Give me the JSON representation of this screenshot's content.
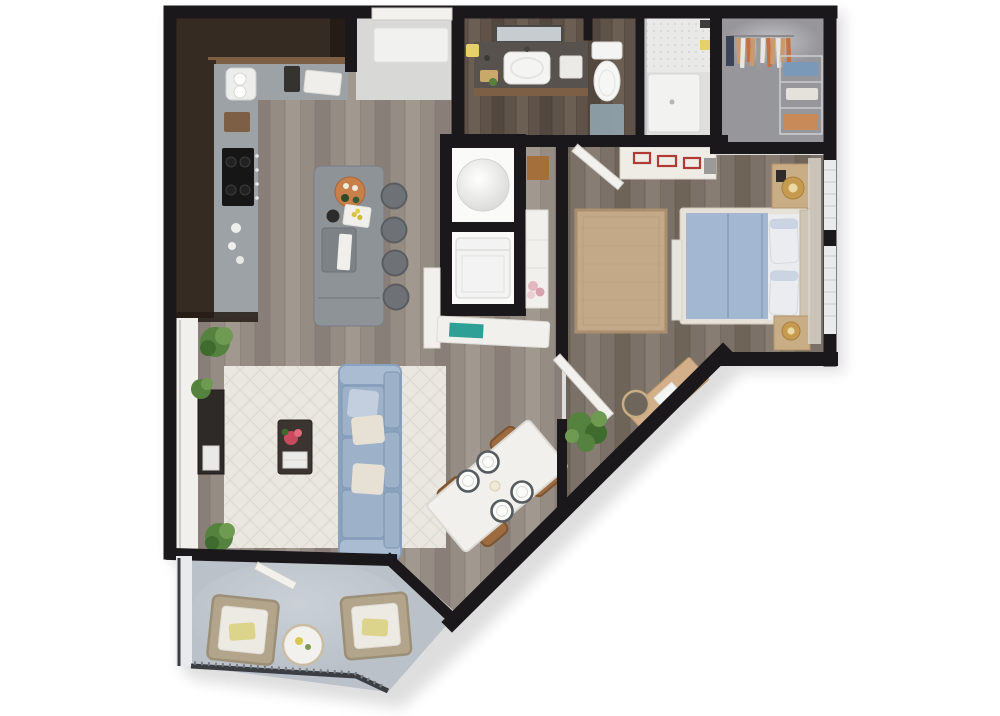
{
  "image_type": "3d-rendered-floor-plan",
  "description": "Top-down 3D dollhouse rendering of a one-bedroom apartment with balcony; no text labels are rendered in the image",
  "rooms": [
    {
      "id": "kitchen",
      "name": "kitchen",
      "contents": [
        "dark-l-shaped-cabinets",
        "double-sink",
        "cooktop",
        "refrigerator-column",
        "island-with-prep-sink",
        "four-bar-stools"
      ]
    },
    {
      "id": "entry",
      "name": "entry",
      "contents": [
        "entry-door",
        "white-door-mat"
      ]
    },
    {
      "id": "bathroom",
      "name": "bathroom",
      "contents": [
        "mirror",
        "vanity-with-basin",
        "toilet",
        "bath-mat",
        "walk-in-shower"
      ]
    },
    {
      "id": "closet",
      "name": "walk-in-closet",
      "contents": [
        "hanging-clothes-rod",
        "wire-shelving-with-folded-clothes"
      ]
    },
    {
      "id": "laundry",
      "name": "laundry-utility-closet",
      "contents": [
        "round-water-heater",
        "washer",
        "tall-white-cabinet",
        "bench-with-books",
        "flowers"
      ]
    },
    {
      "id": "bedroom",
      "name": "bedroom",
      "contents": [
        "bed-blue-duvet",
        "two-pillows",
        "headboard",
        "two-nightstands",
        "two-gold-lamps",
        "jute-rug",
        "dresser-with-red-runner",
        "corner-desk",
        "desk-chair",
        "windows-with-curtains"
      ]
    },
    {
      "id": "living",
      "name": "living-room",
      "contents": [
        "blue-sofa",
        "cream-area-rug",
        "dark-coffee-table",
        "red-flowers",
        "media-console",
        "three-plants",
        "window-bay"
      ]
    },
    {
      "id": "dining",
      "name": "dining-nook",
      "contents": [
        "white-table-rotated",
        "four-wood-chairs",
        "four-place-settings",
        "floor-plant"
      ]
    },
    {
      "id": "balcony",
      "name": "balcony",
      "contents": [
        "two-wicker-chairs",
        "yellow-pillows",
        "round-side-table",
        "railing"
      ]
    }
  ],
  "palette": {
    "wall": "#1b181c",
    "shadow": "#dedede",
    "floor_main": "#958c84",
    "floor_main_dark": "#897f78",
    "floor_main_light": "#a1988f",
    "floor_main_line": "#7b7269",
    "floor_bed": "#7b7169",
    "floor_bed_dark": "#6f6458",
    "floor_bed_light": "#877d73",
    "floor_bed_line": "#5e554d",
    "floor_bath": "#5f5349",
    "floor_bath_dark": "#534840",
    "floor_bath_light": "#6b5e53",
    "floor_bath_line": "#463c34",
    "floor_closet": "#97969a",
    "closet_glow": "#cacace",
    "floor_entry": "#d8d8d7",
    "floor_balcony": "#bac1c8",
    "balcony_glow": "#ccd2d8",
    "cab_dark": "#362b22",
    "cab_darker": "#241c15",
    "wood_accent": "#7d5f45",
    "counter": "#9da2a6",
    "counter_dark": "#7c8286",
    "island": "#8e9397",
    "stool": "#6e7276",
    "stool_edge": "#595d61",
    "cooktop": "#161616",
    "white_soft": "#f1f0ec",
    "appliance": "#f3f3f3",
    "appliance_edge": "#d2d2cf",
    "door_white": "#f2f1ed",
    "door_edge": "#cfccc5",
    "glass": "#e9eaeb",
    "mirror": "#c7ccd1",
    "glass_line": "#b9c0c5",
    "rug_living": "#eae7e0",
    "rug_living_pattern": "#dfdbd1",
    "sofa": "#9db1c9",
    "sofa_dark": "#8ba2bf",
    "sofa_light": "#a9bcd2",
    "sofa_edge": "#7f97b4",
    "pillow_cream": "#e6e1d4",
    "pillow_blue": "#c3cede",
    "pillow_white": "#eaecef",
    "pillow_edge": "#d6d9dc",
    "duvet": "#a3b7d2",
    "duvet_seam": "#8ea5c2",
    "bed_frame": "#e6e1d9",
    "bed_frame_edge": "#d2cabc",
    "headboard": "#cfc5b5",
    "rug_bed": "#c3a987",
    "rug_bed_border": "#a98f6d",
    "rug_bed_line": "#b89e7c",
    "nightstand": "#c9ad85",
    "nightstand_edge": "#b3926a",
    "gold": "#c79b4f",
    "gold_light": "#ead9a4",
    "gold_edge": "#a87f3f",
    "dresser": "#efece6",
    "dresser_edge": "#d8d4cc",
    "pattern_red": "#b23a34",
    "desk": "#d3b089",
    "chair_seat": "#6e655c",
    "wood_chair": "#9c6b3f",
    "wood_chair_dark": "#7e5430",
    "table_white": "#f1f0ec",
    "table_edge": "#dcdad4",
    "plate_rim": "#565b5f",
    "plant": "#55823f",
    "plant_dark": "#3f6b2f",
    "plant_light": "#6e9a52",
    "red": "#c94a5e",
    "red_light": "#e06a7a",
    "coffee_table": "#3c3430",
    "tv_console": "#2d2a27",
    "wicker": "#b3a58c",
    "wicker_edge": "#9c8f77",
    "cushion": "#eceae3",
    "pillow_yellow": "#ddd48c",
    "railing": "#3a3d42",
    "railing_hatch": "#787d83",
    "mat_blue": "#8fa3ad",
    "towel_yellow": "#e5d06a",
    "teal": "#2fa096",
    "flower_pink": "#e3b7bd",
    "flower_pink2": "#d8a2aa",
    "cloth_tan": "#c89a6e",
    "cloth_orange": "#c4713f",
    "cloth_white": "#e8e6e2",
    "cloth_gray": "#9a9a9a",
    "cloth_navy": "#3c4354",
    "fold_blue": "#7a98b8",
    "fold_rust": "#c98a5a",
    "wire": "#c9ccd0",
    "brown_box": "#a56f3c"
  }
}
